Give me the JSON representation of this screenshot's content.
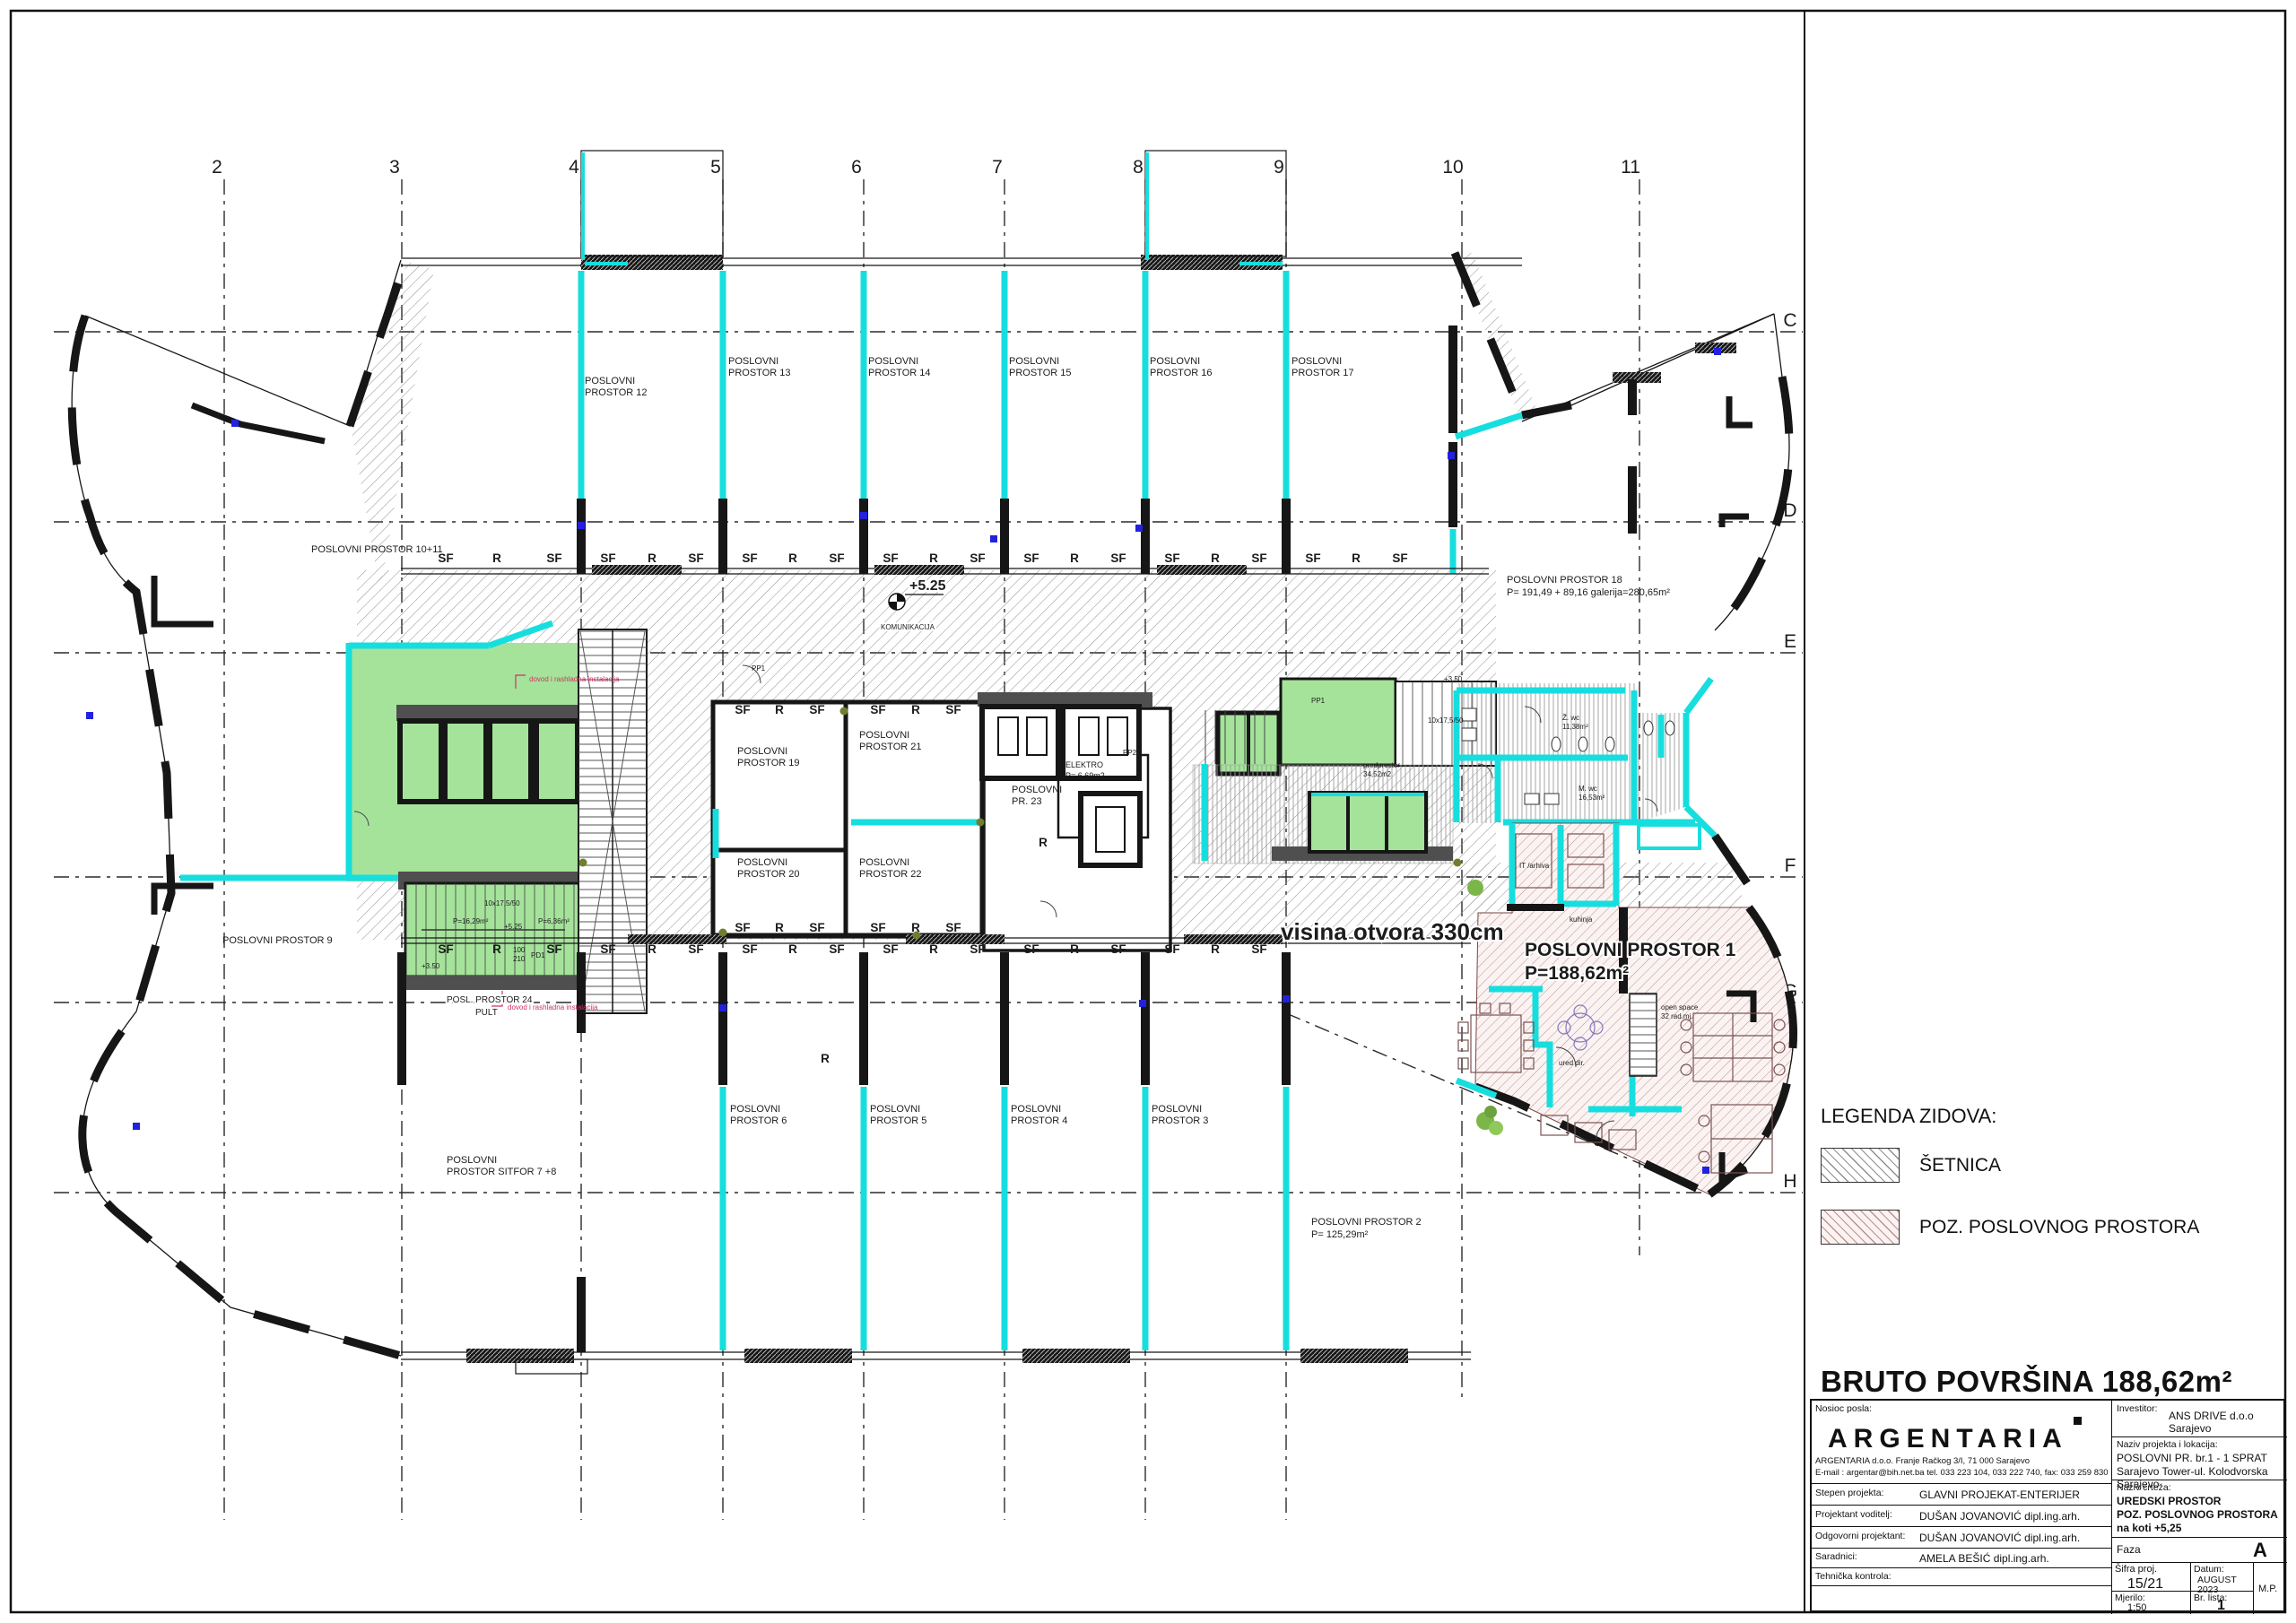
{
  "colors": {
    "pagebg": "#ffffff",
    "cyan": "#17dede",
    "green": "#a5e39b",
    "hatchline": "#8f8f8f",
    "pinkline": "#bf8f8f",
    "pinkbg": "#faf3f2",
    "darkwall": "#4f4f4f",
    "stripe": "#9a9a9a",
    "blue": "#2222dd",
    "olive": "#6f7f2f",
    "red": "#cc3366"
  },
  "header": {
    "bruto": "BRUTO POVRŠINA 188,62m²"
  },
  "legend": {
    "title": "LEGENDA ZIDOVA:",
    "setnica": "ŠETNICA",
    "poslovni": "POZ. POSLOVNOG PROSTORA"
  },
  "grid": {
    "cols": [
      "2",
      "3",
      "4",
      "5",
      "6",
      "7",
      "8",
      "9",
      "10",
      "11"
    ],
    "rows": [
      "C",
      "D",
      "E",
      "F",
      "G",
      "H"
    ]
  },
  "facade": {
    "sf": "SF",
    "r": "R"
  },
  "rooms": {
    "r12": [
      "POSLOVNI",
      "PROSTOR 12"
    ],
    "r13": [
      "POSLOVNI",
      "PROSTOR 13"
    ],
    "r14": [
      "POSLOVNI",
      "PROSTOR 14"
    ],
    "r15": [
      "POSLOVNI",
      "PROSTOR 15"
    ],
    "r16": [
      "POSLOVNI",
      "PROSTOR 16"
    ],
    "r17": [
      "POSLOVNI",
      "PROSTOR 17"
    ],
    "r1011": "POSLOVNI PROSTOR 10+11",
    "r18": [
      "POSLOVNI PROSTOR 18",
      "P= 191,49 + 89,16 galerija=280,65m²"
    ],
    "r9": "POSLOVNI PROSTOR 9",
    "r78": [
      "POSLOVNI",
      "PROSTOR SITFOR 7 +8"
    ],
    "r6": [
      "POSLOVNI",
      "PROSTOR 6"
    ],
    "r5": [
      "POSLOVNI",
      "PROSTOR 5"
    ],
    "r4": [
      "POSLOVNI",
      "PROSTOR 4"
    ],
    "r3": [
      "POSLOVNI",
      "PROSTOR 3"
    ],
    "r2": [
      "POSLOVNI PROSTOR 2",
      "P= 125,29m²"
    ],
    "r1": [
      "POSLOVNI PROSTOR 1",
      "P=188,62m²"
    ],
    "r19": [
      "POSLOVNI",
      "PROSTOR 19"
    ],
    "r20": [
      "POSLOVNI",
      "PROSTOR 20"
    ],
    "r21": [
      "POSLOVNI",
      "PROSTOR 21"
    ],
    "r22": [
      "POSLOVNI",
      "PROSTOR 22"
    ],
    "r23": [
      "POSLOVNI",
      "PR. 23"
    ],
    "r24": [
      "POSL. PROSTOR 24",
      "PULT"
    ],
    "elektro": [
      "ELEKTRO",
      "P= 6,69m2"
    ]
  },
  "annotations": {
    "visina": "visina otvora 330cm",
    "level525": "+5.25",
    "level350": "+3.50",
    "komunikacija": "KOMUNIKACIJA",
    "openspace1": "open space",
    "openspace2": "32 rad.mj.",
    "ureddir": "ured dir.",
    "kuhinja": "kuhinja",
    "arhiva": "IT /arhiva",
    "pp1": "PP1",
    "pp2": "PP2",
    "pd1": "PD1",
    "d100": "100",
    "d210": "210",
    "zwc": "Ž. wc",
    "zwc_p": "11,38m²",
    "mwc": "M. wc",
    "mwc_p": "16,53m²",
    "pred1": "predprostor",
    "pred2": "34,52m2",
    "p1629": "P=16,29m²",
    "p636": "P=6,36m²",
    "stdim": "10x17,5/50",
    "dovod": "dovod i rashladna instalacija"
  },
  "titleblock": {
    "nosioc_label": "Nosioc posla:",
    "company": "ARGENTARIA",
    "addr1": "ARGENTARIA d.o.o. Franje Račkog 3/I, 71 000 Sarajevo",
    "addr2": "E-mail : argentar@bih.net.ba tel. 033 223 104, 033 222 740, fax: 033 259 830",
    "stepen_label": "Stepen projekta:",
    "stepen": "GLAVNI PROJEKAT-ENTERIJER",
    "voditelj_label": "Projektant voditelj:",
    "voditelj": "DUŠAN JOVANOVIĆ dipl.ing.arh.",
    "odgovorni_label": "Odgovorni projektant:",
    "odgovorni": "DUŠAN JOVANOVIĆ dipl.ing.arh.",
    "saradnici_label": "Saradnici:",
    "saradnici": "AMELA BEŠIĆ dipl.ing.arh.",
    "kontrola_label": "Tehnička kontrola:",
    "kontrola": "",
    "investitor_label": "Investitor:",
    "investitor": "ANS DRIVE d.o.o Sarajevo",
    "naziv_label": "Naziv projekta i lokacija:",
    "naziv1": "POSLOVNI PR. br.1 - 1 SPRAT",
    "naziv2": "Sarajevo Tower-ul. Kolodvorska  Sarajevo",
    "crtez_label": "Naziv crteža:",
    "crtez1": "UREDSKI PROSTOR",
    "crtez2": "POZ. POSLOVNOG PROSTORA",
    "crtez3": "na koti +5,25",
    "faza_label": "Faza",
    "faza": "A",
    "sifra_label": "Šifra proj.",
    "sifra": "15/21",
    "datum_label": "Datum:",
    "datum1": "AUGUST",
    "datum2": "2023",
    "mp": "M.P.",
    "mjerilo_label": "Mjerilo:",
    "mjerilo": "1:50",
    "lista_label": "Br. lista:",
    "lista": "1"
  }
}
